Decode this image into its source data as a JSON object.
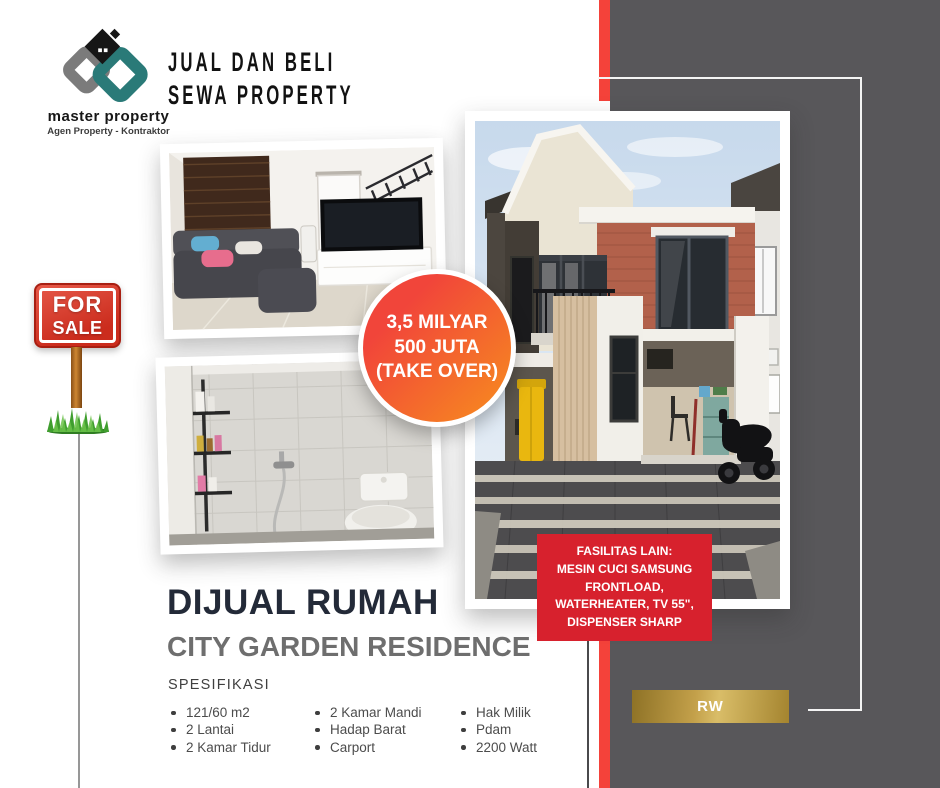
{
  "logo": {
    "name": "master property",
    "tagline": "Agen Property - Kontraktor",
    "icon": "interlocked-house-monogram"
  },
  "header": {
    "line1": "JUAL DAN BELI",
    "line2": "SEWA PROPERTY"
  },
  "sale_sign": {
    "line1": "FOR",
    "line2": "SALE"
  },
  "price_badge": {
    "line1": "3,5 MILYAR",
    "line2": "500 JUTA",
    "line3": "(TAKE OVER)"
  },
  "facilities": {
    "line1": "FASILITAS LAIN:",
    "line2": "MESIN CUCI SAMSUNG",
    "line3": "FRONTLOAD,",
    "line4": "WATERHEATER, TV 55\",",
    "line5": "DISPENSER SHARP"
  },
  "listing": {
    "title": "DIJUAL RUMAH",
    "subtitle": "CITY GARDEN RESIDENCE",
    "spec_label": "SPESIFIKASI",
    "specs_col1": [
      "121/60 m2",
      "2 Lantai",
      "2 Kamar Tidur"
    ],
    "specs_col2": [
      "2 Kamar Mandi",
      "Hadap Barat",
      "Carport"
    ],
    "specs_col3": [
      "Hak Milik",
      "Pdam",
      "2200 Watt"
    ]
  },
  "rw_badge": {
    "label": "RW"
  },
  "photos": {
    "living_room": "living-room-photo",
    "bathroom": "bathroom-photo",
    "house_exterior": "house-exterior-photo"
  },
  "colors": {
    "accent_red": "#F4423A",
    "facility_red": "#D7212D",
    "sign_red": "#CB2C1D",
    "panel_gray": "#58575A",
    "gold": "#C3A04A",
    "teal": "#2A7A78",
    "heading_navy": "#232A38",
    "subtitle_gray": "#6E6E6E",
    "price_gradient_start": "#F1453A",
    "price_gradient_end": "#F78E1E"
  }
}
